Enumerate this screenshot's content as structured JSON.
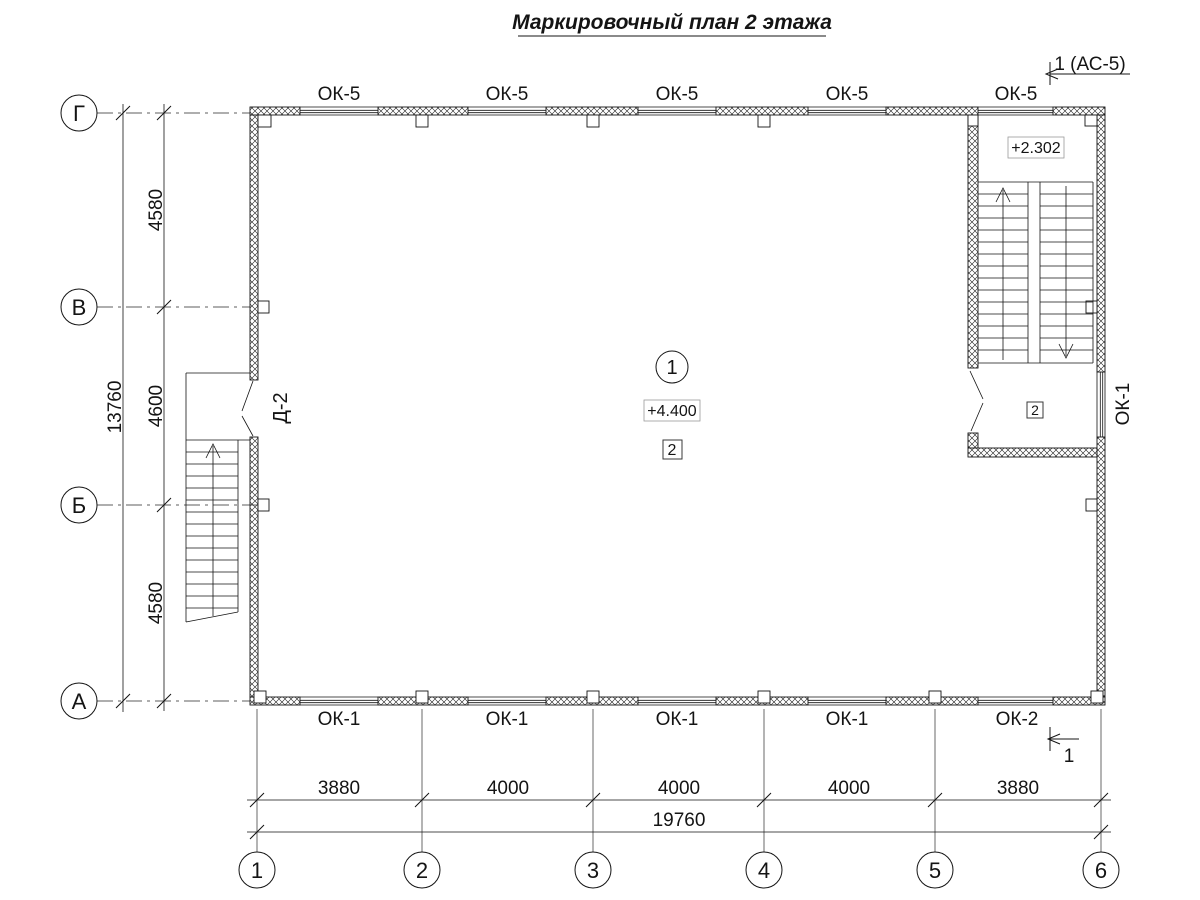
{
  "title": "Маркировочный план 2 этажа",
  "ink_color": "#141414",
  "axes": {
    "cols": [
      "1",
      "2",
      "3",
      "4",
      "5",
      "6"
    ],
    "rows": [
      "Г",
      "В",
      "Б",
      "А"
    ]
  },
  "dims": {
    "bottom_segments": [
      "3880",
      "4000",
      "4000",
      "4000",
      "3880"
    ],
    "bottom_total": "19760",
    "left_segments": [
      "4580",
      "4600",
      "4580"
    ],
    "left_total": "13760"
  },
  "windows": {
    "top": [
      "ОК-5",
      "ОК-5",
      "ОК-5",
      "ОК-5",
      "ОК-5"
    ],
    "bottom": [
      "ОК-1",
      "ОК-1",
      "ОК-1",
      "ОК-1",
      "ОК-2"
    ],
    "right": "ОК-1"
  },
  "door": {
    "label": "Д-2"
  },
  "marks": {
    "section_top": "1 (АС-5)",
    "section_bottom": "1"
  },
  "rooms": {
    "main": {
      "number": "1",
      "level": "+4.400",
      "tag": "2"
    },
    "stair": {
      "level": "+2.302",
      "tag": "2"
    }
  }
}
